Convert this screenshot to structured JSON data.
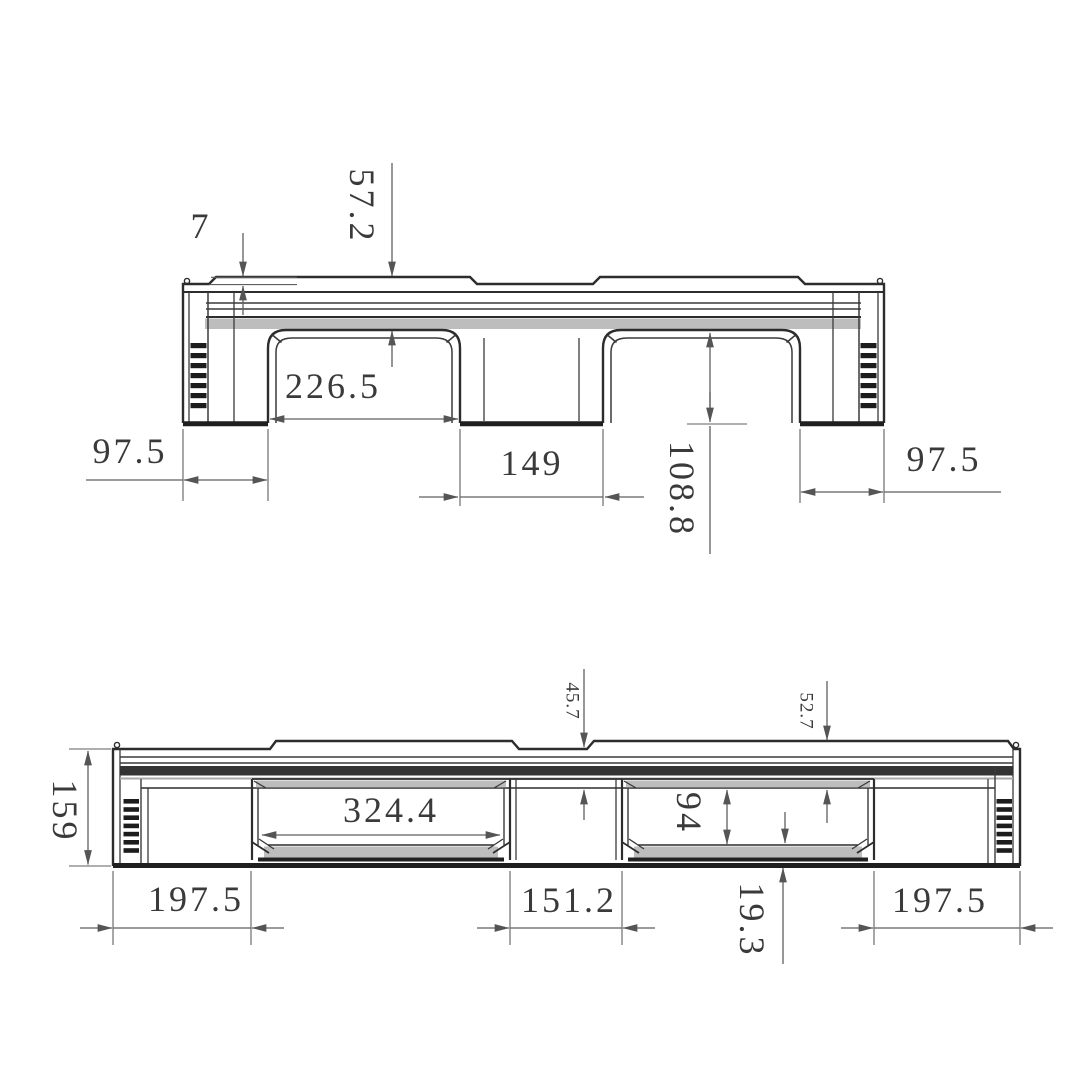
{
  "side_view": {
    "dims": {
      "lip_height": "7",
      "deck_thickness": "57.2",
      "fork_opening_width": "226.5",
      "center_leg_width": "149",
      "opening_height": "108.8",
      "left_end_width": "97.5",
      "right_end_width": "97.5"
    }
  },
  "end_view": {
    "dims": {
      "overall_height": "159",
      "deck_thickness_at_notch": "45.7",
      "deck_thickness": "52.7",
      "window_width": "324.4",
      "window_height": "94",
      "bottom_deck_thickness": "19.3",
      "left_end_width": "197.5",
      "center_block_width": "151.2",
      "right_end_width": "197.5"
    }
  },
  "colors": {
    "background": "#ffffff",
    "outline": "#2d2d2d",
    "dimension_line": "#5f5f5f",
    "shading": "#bdbdbd",
    "dark_band": "#343434",
    "hatch": "#1c1c1c",
    "text": "#3a3a3a"
  }
}
